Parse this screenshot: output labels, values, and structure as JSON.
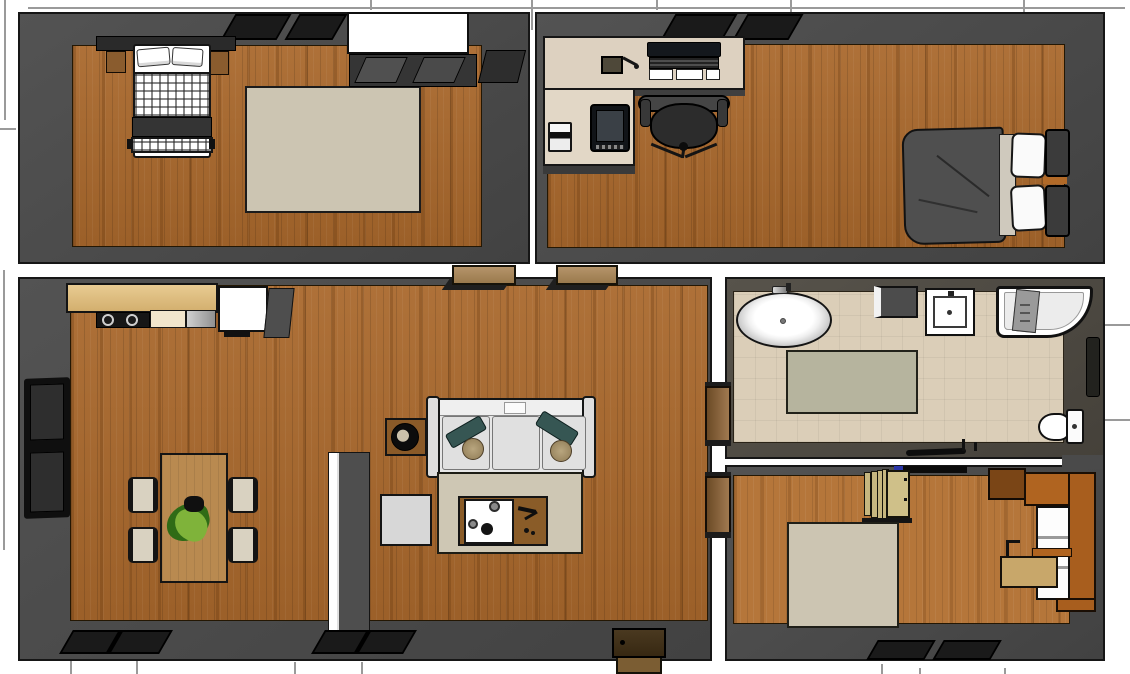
{
  "meta": {
    "title": "Apartment floor plan - 3D top-down dollhouse render",
    "view": "orthographic-like top view with cut walls",
    "canvas": {
      "width": 1130,
      "height": 674
    },
    "visible_text": "none"
  },
  "palette": {
    "background": "#ffffff",
    "wall": "#4a4a4a",
    "wall_outline": "#161616",
    "wood_floor": "#a9682c",
    "wood_floor_light": "#b5763a",
    "tile_floor": "#dbceb8",
    "rug_beige": "#ccc5b2",
    "rug_sage": "#b6b49e",
    "counter_wood": "#dcba7e",
    "desk_beige": "#ddd1c0",
    "accent_orange_wood": "#b06420",
    "sofa_gray": "#e6e6e6",
    "pillow_teal": "#365653",
    "duvet_dark": "#4f4f4f",
    "plant_green": "#7fb33a",
    "door_wood": "#9a7a4d"
  },
  "rooms": [
    {
      "id": "bedroom-top-left",
      "label": "Bedroom (top left)",
      "floor": "wood",
      "furniture": [
        "double bed with checkered duvet",
        "headboard shelf with nightstands",
        "beige area rug",
        "wardrobe with white storage box",
        "dresser",
        "windows in top wall"
      ]
    },
    {
      "id": "office-bedroom-top-right",
      "label": "Office bedroom (top right)",
      "floor": "wood",
      "furniture": [
        "L-shaped desk",
        "monitor with keyboard",
        "office chair",
        "printer",
        "tablet",
        "double bed with dark grey duvet",
        "windows in top wall",
        "desk organizer"
      ]
    },
    {
      "id": "living-room-kitchen",
      "label": "Living room with open kitchen (left)",
      "floor": "wood",
      "furniture": [
        "kitchen counter with cooktop",
        "refrigerator",
        "dining table",
        "dining chair",
        "houseplant",
        "partial divider wall",
        "record player on box",
        "3-seat sofa with teal pillows",
        "beige rug",
        "coffee table with white tray",
        "square side table",
        "tall window in left wall",
        "window in bottom wall",
        "entry door",
        "entry step"
      ]
    },
    {
      "id": "bathroom",
      "label": "Bathroom (middle right)",
      "floor": "tile",
      "furniture": [
        "freestanding oval bathtub",
        "cabinet",
        "square washbasin",
        "corner shower with curved glass",
        "sage bath rug",
        "toilet",
        "towel niche"
      ]
    },
    {
      "id": "bedroom-bottom-right",
      "label": "Bedroom (bottom right)",
      "floor": "wood",
      "furniture": [
        "folding screen",
        "beige area rug",
        "desk wall unit with shelves",
        "bench with tan cushion",
        "overhead cabinet",
        "windows in bottom wall"
      ]
    }
  ],
  "doors": [
    {
      "id": "door-top-1",
      "label": "doorway: top-left bedroom to living room"
    },
    {
      "id": "door-top-2",
      "label": "doorway: office bedroom to living room"
    },
    {
      "id": "door-bathroom",
      "label": "bathroom door"
    },
    {
      "id": "door-bedroom-bottom",
      "label": "bottom bedroom door"
    },
    {
      "id": "door-entry",
      "label": "entry door with outside step"
    }
  ]
}
